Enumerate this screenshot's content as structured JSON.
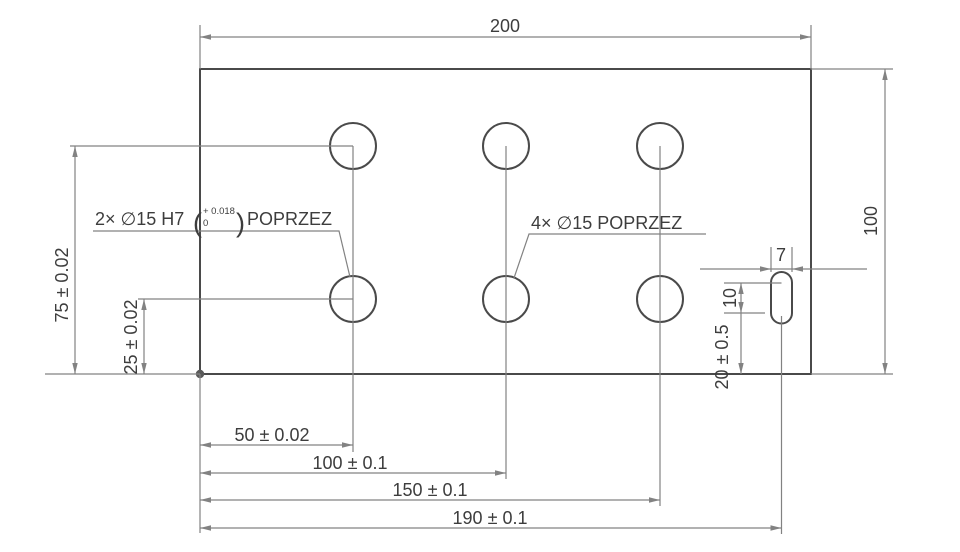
{
  "drawing_type": "2D technical drawing of rectangular plate with 6 drilled holes and 1 slot",
  "colors": {
    "plate_fill": "#c9dbfa",
    "edge_line": "#4a4a4a",
    "dim_line": "#828282",
    "text": "#3d3d3d"
  },
  "labels": {
    "width_top": "200",
    "height_right": "100",
    "row_top": "75 ± 0.02",
    "row_bottom": "25 ± 0.02",
    "col1": "50 ± 0.02",
    "col2": "100 ± 0.1",
    "col3": "150 ± 0.1",
    "slot_pos": "190 ± 0.1",
    "slot_width": "7",
    "slot_spacing": "10",
    "slot_bottom": "20 ± 0.5"
  },
  "callouts": {
    "reamed": {
      "prefix": "2× ∅15 H7",
      "paren_open": "(",
      "tol_upper": "+ 0.018",
      "tol_lower": "0",
      "paren_close": ")",
      "suffix": "POPRZEZ"
    },
    "plain": {
      "text": "4× ∅15 POPRZEZ"
    }
  }
}
